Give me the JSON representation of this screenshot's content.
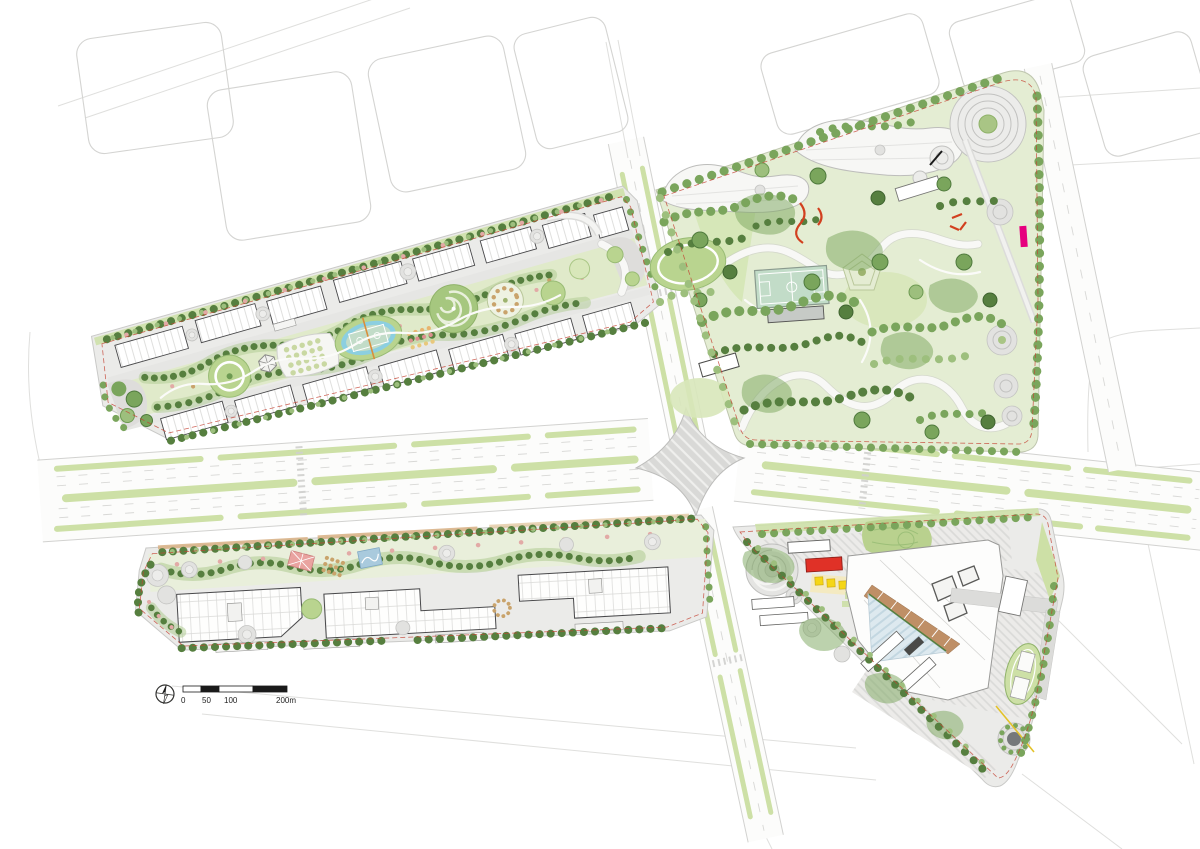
{
  "document": {
    "kind": "landscape-masterplan-site-plan",
    "background": "#ffffff"
  },
  "scale_bar": {
    "labels": [
      "0",
      "50",
      "100",
      "200m"
    ]
  },
  "compass": {
    "icon": "north-arrow"
  },
  "features": {
    "north_residential": "north-residential-block",
    "south_residential": "south-residential-block",
    "central_park": "central-park",
    "commercial_block": "commercial-mixed-use-block",
    "boulevard": "tree-lined-boulevard",
    "intersection": "central-intersection-plaza",
    "court_oval": "basketball-court-in-pool-oval",
    "park_court": "park-basketball-court",
    "spiral_lawn": "spiral-lawn",
    "amphitheater": "concentric-ring-garden",
    "tennis_court": "pink-sport-court",
    "playground": "blue-playground",
    "glass_atrium": "triangular-glass-atrium",
    "running_track": "oval-running-track",
    "sunken_garden": "sunken-circle-garden",
    "marker": "magenta-section-marker"
  },
  "colors": {
    "context_line": "#d4d4d2",
    "parcel_base": "#ebebe9",
    "park_base": "#e4edd3",
    "road_surface": "#fcfcfb",
    "road_edge": "#d2d2d0",
    "median_green": "#cde0a6",
    "lawn": "#b9d48f",
    "lawn_light": "#d8e7ba",
    "tree_dark": "#567f3f",
    "tree_mid": "#7aa55c",
    "tree_light": "#9dbf7d",
    "pink_tree": "#e2aaa6",
    "building_line": "#48484a",
    "plaza_gray": "#dcdcda",
    "water_blue": "#8ccfe0",
    "court_green": "#c2dcc8",
    "sport_pink": "#e9a3a0",
    "play_blue": "#a9cadd",
    "canopy_yellow": "#f5d616",
    "accent_red": "#e03127",
    "terrace_tan": "#bf8f66",
    "step_coral": "#e8a87c",
    "glass_blue": "#dde9ef",
    "marker_magenta": "#e6007e",
    "boundary_red": "#c44233",
    "scale_black": "#1a1a1a"
  }
}
